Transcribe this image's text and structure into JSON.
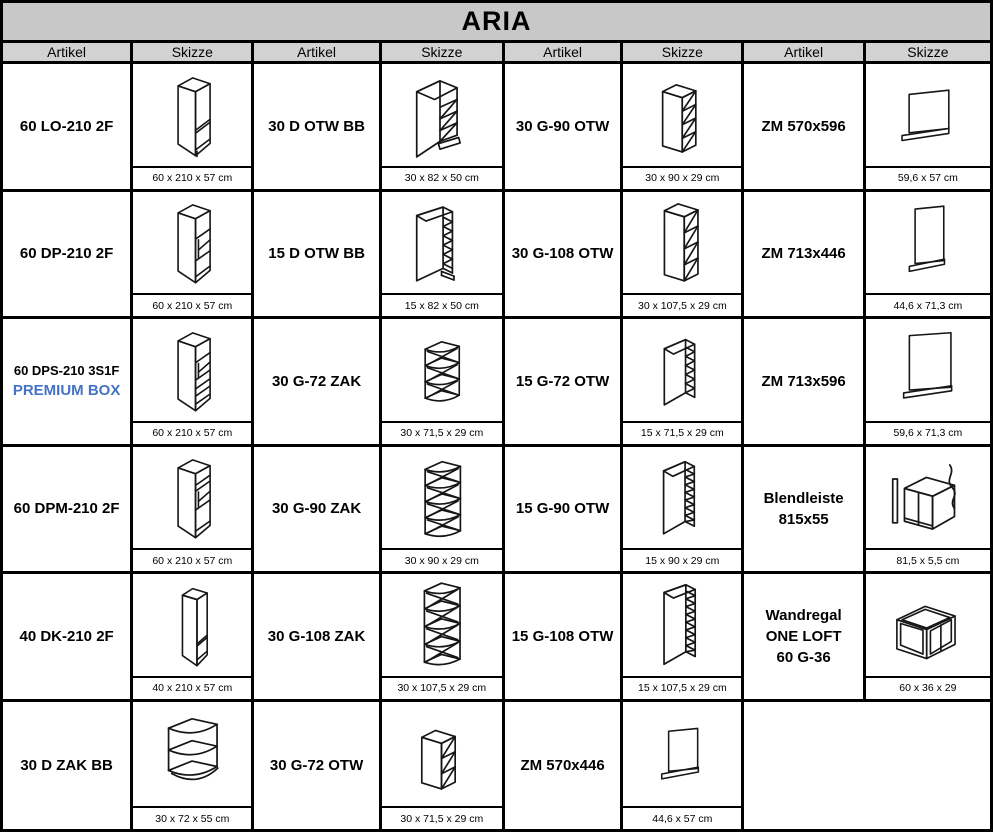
{
  "title": "ARIA",
  "column_headers": [
    "Artikel",
    "Skizze",
    "Artikel",
    "Skizze",
    "Artikel",
    "Skizze",
    "Artikel",
    "Skizze"
  ],
  "colors": {
    "title_bg": "#c8c8c8",
    "header_bg": "#d2d2d2",
    "border": "#000000",
    "premium_blue": "#4472C4",
    "sketch_line": "#161616"
  },
  "rows": [
    [
      {
        "article": [
          "60 LO-210 2F"
        ],
        "sketch": "tall-cabinet-2f",
        "dimensions": "60 x 210 x 57 cm"
      },
      {
        "article": [
          "30 D OTW BB"
        ],
        "sketch": "base-cargo-open-shelf",
        "dimensions": "30 x 82 x 50 cm"
      },
      {
        "article": [
          "30 G-90 OTW"
        ],
        "sketch": "wall-open-shelf-4",
        "dimensions": "30 x 90 x 29 cm"
      },
      {
        "article": [
          "ZM 570x596"
        ],
        "sketch": "end-panel-square",
        "dimensions": "59,6 x 57 cm"
      }
    ],
    [
      {
        "article": [
          "60 DP-210 2F"
        ],
        "sketch": "tall-oven-housing",
        "dimensions": "60 x 210 x 57 cm"
      },
      {
        "article": [
          "15 D OTW BB"
        ],
        "sketch": "base-cargo-open-shelf-narrow",
        "dimensions": "15 x 82 x 50 cm"
      },
      {
        "article": [
          "30 G-108 OTW"
        ],
        "sketch": "wall-open-shelf-4-tall",
        "dimensions": "30 x 107,5 x 29 cm"
      },
      {
        "article": [
          "ZM 713x446"
        ],
        "sketch": "end-panel-tall-narrow",
        "dimensions": "44,6 x 71,3 cm"
      }
    ],
    [
      {
        "article": [
          "60 DPS-210 3S1F",
          "PREMIUM BOX"
        ],
        "highlight_line": 1,
        "sketch": "tall-oven-housing-drawers",
        "dimensions": "60 x 210 x 57 cm"
      },
      {
        "article": [
          "30 G-72 ZAK"
        ],
        "sketch": "corner-open-shelf-4",
        "dimensions": "30 x 71,5 x 29 cm"
      },
      {
        "article": [
          "15 G-72 OTW"
        ],
        "sketch": "wall-open-shelf-narrow-short",
        "dimensions": "15 x 71,5 x 29 cm"
      },
      {
        "article": [
          "ZM 713x596"
        ],
        "sketch": "end-panel-tall-wide",
        "dimensions": "59,6 x 71,3 cm"
      }
    ],
    [
      {
        "article": [
          "60 DPM-210 2F"
        ],
        "sketch": "tall-microwave-housing",
        "dimensions": "60 x 210 x 57 cm"
      },
      {
        "article": [
          "30 G-90 ZAK"
        ],
        "sketch": "corner-open-shelf-5",
        "dimensions": "30 x 90 x 29 cm"
      },
      {
        "article": [
          "15 G-90 OTW"
        ],
        "sketch": "wall-open-shelf-narrow-mid",
        "dimensions": "15 x 90 x 29 cm"
      },
      {
        "article": [
          "Blendleiste",
          "815x55"
        ],
        "sketch": "filler-strip-cabinet",
        "dimensions": "81,5 x 5,5 cm"
      }
    ],
    [
      {
        "article": [
          "40 DK-210 2F"
        ],
        "sketch": "tall-cabinet-narrow",
        "dimensions": "40 x 210 x 57 cm"
      },
      {
        "article": [
          "30 G-108 ZAK"
        ],
        "sketch": "corner-open-shelf-5-tall",
        "dimensions": "30 x 107,5 x 29 cm"
      },
      {
        "article": [
          "15 G-108 OTW"
        ],
        "sketch": "wall-open-shelf-narrow-tall",
        "dimensions": "15 x 107,5 x 29 cm"
      },
      {
        "article": [
          "Wandregal",
          "ONE LOFT",
          "60 G-36"
        ],
        "sketch": "open-frame-wall-shelf",
        "dimensions": "60 x 36 x 29"
      }
    ],
    [
      {
        "article": [
          "30 D ZAK BB"
        ],
        "sketch": "corner-base-open-shelf",
        "dimensions": "30 x 72 x 55 cm"
      },
      {
        "article": [
          "30 G-72 OTW"
        ],
        "sketch": "wall-open-shelf-3",
        "dimensions": "30 x 71,5 x 29 cm"
      },
      {
        "article": [
          "ZM 570x446"
        ],
        "sketch": "end-panel-small",
        "dimensions": "44,6 x 57 cm"
      },
      {
        "empty": true
      }
    ]
  ]
}
